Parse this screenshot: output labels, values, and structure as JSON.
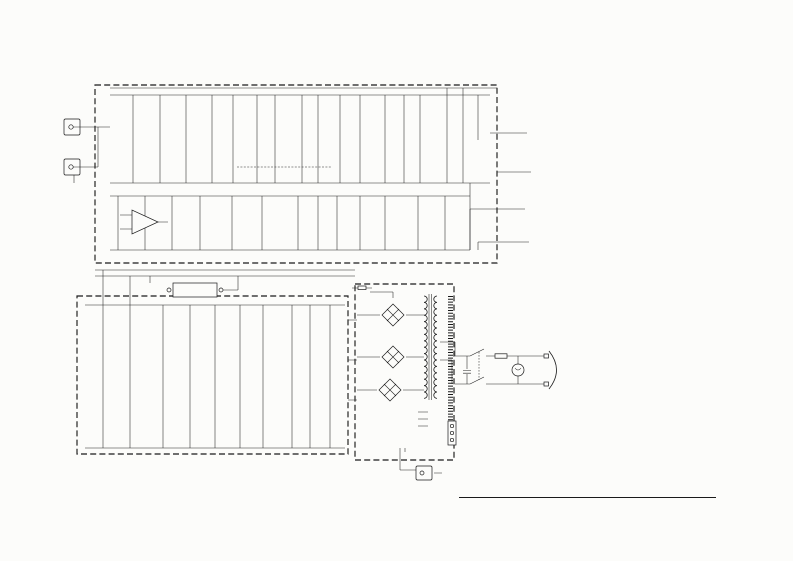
{
  "corner_models": [
    "G100-115 (S/N 1026~)",
    "G100-410 (S/N 1026~)",
    "G100-412 (S/N 1026~)"
  ],
  "sections": {
    "pa": "PA(PAGE 7)",
    "ma": "MA(PAGE 8)",
    "dc": "DC(PAGE 8)"
  },
  "input_label": "INPUT",
  "opamp_label": "AN374",
  "reverb_unit_label": "REVERB UNIT",
  "rec_out_label": "REC OUT",
  "page_number": "4",
  "title": "G100, -115, -410, -412 GUITAR AMPLIFIER SCHEMATIC DIAGRAM",
  "out_jacks": [
    {
      "lines": [
        "PRE-SET",
        "VOLUME"
      ],
      "x": 526,
      "y": 117
    },
    {
      "lines": [
        "DISTORTION"
      ],
      "x": 530,
      "y": 162
    },
    {
      "lines": [
        "TREMOLO"
      ],
      "x": 524,
      "y": 198
    },
    {
      "lines": [
        "REVERB"
      ],
      "x": 528,
      "y": 231
    }
  ],
  "notes": {
    "title": "NOTES:",
    "items": [
      {
        "t": "1. ALL RESISTORS IN OHMS ½ WATT UNLESS OTHERWISE NOTED."
      },
      {
        "t": "2. ALL CAPACITORS IN MFD. UNLESS OTHERWISE NOTED."
      },
      {
        "t": "3. ALL VOLTAGES MEASURED WITH A VTVM, WITH ALL CONTROLS"
      },
      {
        "t": "SET AT MINIMUM.",
        "indent": 1
      },
      {
        "t": "4. WIRE COLOR ABBREVIATIONS"
      },
      {
        "cols": [
          "BL:  BLACK",
          "GR:  GREEN",
          "GG:  LIGHT GREEN"
        ]
      },
      {
        "cols": [
          "BR:  BROWN",
          "BE:  BLUE",
          "SB:  LIGHT BLUE"
        ]
      },
      {
        "cols": [
          "RE:  RED",
          "VI:  VIOLET",
          "PK:  PINK"
        ]
      },
      {
        "cols": [
          "OR:  ORANGE",
          "GY:  GRAY",
          "TR:  TRANSPARENT"
        ]
      },
      {
        "cols": [
          "YE:  YELLOW",
          "WH:  WHITE",
          "TP:  TIN PLATED"
        ]
      },
      {
        "t": "5. TRANSISTORS"
      },
      {
        "t": "TR1, 5, 11, 13-14:  2SK30A (FET)",
        "indent": 1
      },
      {
        "t": "TR2-4, 6-10, 12, 15:  2SC1000",
        "indent": 1
      },
      {
        "t": "TR16:  2SA561",
        "indent": 1
      },
      {
        "t": "TR17-18:  2SA816",
        "indent": 1
      },
      {
        "t": "TR19-20:  2SC793",
        "indent": 1
      },
      {
        "t": "TR21:  2SA482",
        "indent": 1
      },
      {
        "t": "TR22-23:  2SC1985",
        "indent": 1
      },
      {
        "t": "TR24:  2SC684",
        "indent": 1
      },
      {
        "t": "6. DIODES"
      },
      {
        "t": "D1:  STV-3H (VARISTOR)",
        "indent": 1
      },
      {
        "t": "D2-3:  OS151",
        "indent": 1
      },
      {
        "t": "D4-5:  OS151B",
        "indent": 1
      },
      {
        "t": "D6-9/10-13:  RS-1",
        "indent": 1
      }
    ]
  },
  "transistors": [
    {
      "id": "TR1",
      "x": 133,
      "y": 128
    },
    {
      "id": "TR2",
      "x": 212,
      "y": 122
    },
    {
      "id": "TR3",
      "x": 257,
      "y": 131
    },
    {
      "id": "TR4",
      "x": 275,
      "y": 112
    },
    {
      "id": "TR5",
      "x": 318,
      "y": 138
    },
    {
      "id": "TR6",
      "x": 420,
      "y": 125
    },
    {
      "id": "TR7",
      "x": 447,
      "y": 111
    },
    {
      "id": "TR8",
      "x": 464,
      "y": 99
    },
    {
      "id": "TR9",
      "x": 232,
      "y": 217
    },
    {
      "id": "TR10",
      "x": 298,
      "y": 210
    },
    {
      "id": "TR11",
      "x": 337,
      "y": 233
    },
    {
      "id": "TR12",
      "x": 418,
      "y": 217
    },
    {
      "id": "TR13",
      "x": 103,
      "y": 372
    },
    {
      "id": "TR14",
      "x": 130,
      "y": 372
    },
    {
      "id": "TR15",
      "x": 163,
      "y": 331
    },
    {
      "id": "TR16",
      "x": 215,
      "y": 332
    },
    {
      "id": "TR17",
      "x": 207,
      "y": 358
    },
    {
      "id": "TR18",
      "x": 230,
      "y": 358
    },
    {
      "id": "TR19",
      "x": 263,
      "y": 345
    },
    {
      "id": "TR20",
      "x": 292,
      "y": 323
    },
    {
      "id": "TR21",
      "x": 293,
      "y": 385
    },
    {
      "id": "TR22",
      "x": 310,
      "y": 342
    },
    {
      "id": "TR23",
      "x": 308,
      "y": 397
    },
    {
      "id": "TR24",
      "x": 250,
      "y": 315
    }
  ],
  "labels": [
    {
      "x": 103,
      "y": 125,
      "t": "68K",
      "res": 1
    },
    {
      "x": 103,
      "y": 147,
      "t": "68K",
      "res": 1
    },
    {
      "x": 112,
      "y": 104,
      "t": "470/35"
    },
    {
      "x": 117,
      "y": 141,
      "t": "0.047",
      "cap": 1
    },
    {
      "x": 141,
      "y": 107,
      "t": "1/25"
    },
    {
      "x": 158,
      "y": 93,
      "t": "390",
      "res": 1
    },
    {
      "x": 163,
      "y": 112,
      "t": "56K",
      "res": 1
    },
    {
      "x": 168,
      "y": 142,
      "t": "220K",
      "res": 1
    },
    {
      "x": 188,
      "y": 112,
      "t": "8.2K",
      "res": 1
    },
    {
      "x": 201,
      "y": 104,
      "t": "0.0022",
      "cap": 1
    },
    {
      "x": 236,
      "y": 99,
      "t": "270K",
      "res": 1
    },
    {
      "x": 145,
      "y": 118,
      "t": "24.5",
      "box": 1
    },
    {
      "x": 217,
      "y": 136,
      "t": "TREBLE"
    },
    {
      "x": 215,
      "y": 148,
      "t": "BASS"
    },
    {
      "x": 216,
      "y": 160,
      "t": "MIDDLE"
    },
    {
      "x": 198,
      "y": 143,
      "t": "0.047",
      "cap": 1
    },
    {
      "x": 198,
      "y": 156,
      "t": "0.47",
      "cap": 1
    },
    {
      "x": 243,
      "y": 118,
      "t": "150K",
      "res": 1
    },
    {
      "x": 264,
      "y": 104,
      "t": "100K",
      "res": 1
    },
    {
      "x": 287,
      "y": 150,
      "t": "1S1555×2",
      "r": 1
    },
    {
      "x": 305,
      "y": 99,
      "t": "330K",
      "res": 1
    },
    {
      "x": 313,
      "y": 158,
      "t": "10K",
      "res": 1
    },
    {
      "x": 342,
      "y": 103,
      "t": "33K",
      "res": 1
    },
    {
      "x": 353,
      "y": 113,
      "t": "220/25"
    },
    {
      "x": 369,
      "y": 123,
      "t": "0.047",
      "cap": 1
    },
    {
      "x": 391,
      "y": 112,
      "t": "BRIGHT"
    },
    {
      "x": 392,
      "y": 153,
      "t": "VOLUME"
    },
    {
      "x": 384,
      "y": 140,
      "t": "250K",
      "r": 1
    },
    {
      "x": 407,
      "y": 105,
      "t": "22K",
      "res": 1
    },
    {
      "x": 432,
      "y": 105,
      "t": "100K",
      "res": 1
    },
    {
      "x": 472,
      "y": 93,
      "t": "36.8",
      "box": 1
    },
    {
      "x": 452,
      "y": 123,
      "t": "3.3/35"
    },
    {
      "x": 478,
      "y": 143,
      "t": "50K",
      "res": 1
    },
    {
      "x": 489,
      "y": 135,
      "t": "PRE-SET VOLUME",
      "r": 1
    },
    {
      "x": 498,
      "y": 82,
      "t": "+36"
    },
    {
      "x": 266,
      "y": 173,
      "t": "DISTORTION"
    },
    {
      "x": 52,
      "y": 177,
      "t": "+12"
    },
    {
      "x": 112,
      "y": 206,
      "t": "100K",
      "res": 1
    },
    {
      "x": 122,
      "y": 234,
      "t": "4.7K",
      "res": 1
    },
    {
      "x": 143,
      "y": 193,
      "t": "13.8",
      "box": 1
    },
    {
      "x": 160,
      "y": 242,
      "t": "0.0033",
      "cap": 1
    },
    {
      "x": 176,
      "y": 234,
      "t": "22K",
      "res": 1
    },
    {
      "x": 188,
      "y": 214,
      "t": "330/16"
    },
    {
      "x": 218,
      "y": 200,
      "t": "150K",
      "res": 1
    },
    {
      "x": 242,
      "y": 209,
      "t": "1K",
      "res": 1
    },
    {
      "x": 252,
      "y": 232,
      "t": "REVERB",
      "r": 1
    },
    {
      "x": 284,
      "y": 224,
      "t": "3.3/25"
    },
    {
      "x": 291,
      "y": 256,
      "t": "TREMOLO"
    },
    {
      "x": 291,
      "y": 261,
      "t": "INTENSITY"
    },
    {
      "x": 321,
      "y": 198,
      "t": "33/25"
    },
    {
      "x": 350,
      "y": 245,
      "t": "47K",
      "res": 1
    },
    {
      "x": 366,
      "y": 206,
      "t": "1/35",
      "cap": 1
    },
    {
      "x": 391,
      "y": 206,
      "t": "1/35",
      "cap": 1
    },
    {
      "x": 417,
      "y": 197,
      "t": "270K",
      "res": 1
    },
    {
      "x": 433,
      "y": 203,
      "t": "47/25"
    },
    {
      "x": 457,
      "y": 223,
      "t": "8.2K",
      "res": 1
    },
    {
      "x": 90,
      "y": 335,
      "t": "1500/50",
      "r": 1
    },
    {
      "x": 152,
      "y": 309,
      "t": "2.2K",
      "res": 1
    },
    {
      "x": 181,
      "y": 318,
      "t": "180",
      "res": 1
    },
    {
      "x": 198,
      "y": 311,
      "t": "15K",
      "res": 1
    },
    {
      "x": 234,
      "y": 311,
      "t": "5.6K",
      "res": 1
    },
    {
      "x": 243,
      "y": 301,
      "t": "0.1/200",
      "cap": 1
    },
    {
      "x": 102,
      "y": 393,
      "t": "100K",
      "res": 1
    },
    {
      "x": 133,
      "y": 380,
      "t": "10/6"
    },
    {
      "x": 121,
      "y": 399,
      "t": "100K",
      "res": 1
    },
    {
      "x": 137,
      "y": 390,
      "t": "BAL"
    },
    {
      "x": 318,
      "y": 357,
      "t": "0.47 2W",
      "r": 1
    },
    {
      "x": 312,
      "y": 412,
      "t": "0.47 2W",
      "r": 1
    },
    {
      "x": 333,
      "y": 311,
      "t": "560",
      "res": 1
    },
    {
      "x": 265,
      "y": 381,
      "t": "D1"
    },
    {
      "x": 292,
      "y": 303,
      "t": "0.1/200",
      "cap": 1
    },
    {
      "x": 377,
      "y": 306,
      "t": "D2"
    },
    {
      "x": 404,
      "y": 306,
      "t": "D4"
    },
    {
      "x": 377,
      "y": 328,
      "t": "D3"
    },
    {
      "x": 404,
      "y": 328,
      "t": "D5"
    },
    {
      "x": 377,
      "y": 349,
      "t": "D6"
    },
    {
      "x": 404,
      "y": 349,
      "t": "D8"
    },
    {
      "x": 377,
      "y": 370,
      "t": "D7"
    },
    {
      "x": 404,
      "y": 370,
      "t": "D9"
    },
    {
      "x": 373,
      "y": 382,
      "t": "D10"
    },
    {
      "x": 402,
      "y": 382,
      "t": "D12"
    },
    {
      "x": 373,
      "y": 403,
      "t": "D11"
    },
    {
      "x": 402,
      "y": 403,
      "t": "D13"
    },
    {
      "x": 361,
      "y": 284,
      "t": "2A"
    },
    {
      "x": 369,
      "y": 333,
      "t": "0.0047×2"
    },
    {
      "x": 492,
      "y": 345,
      "t": "FOR U.S./CANADIAN MODEL",
      "f": 4
    },
    {
      "x": 498,
      "y": 393,
      "t": "LEAD TYPE 4A"
    },
    {
      "x": 467,
      "y": 409,
      "t": "C 0.0047MF AC 250V"
    },
    {
      "x": 539,
      "y": 352,
      "t": "WH"
    },
    {
      "x": 539,
      "y": 394,
      "t": "BL"
    },
    {
      "x": 431,
      "y": 413,
      "t": "PA(+36)"
    },
    {
      "x": 431,
      "y": 420,
      "t": "PA(+12)"
    },
    {
      "x": 431,
      "y": 427,
      "t": "E"
    },
    {
      "x": 404,
      "y": 457,
      "t": "1000/100",
      "cap": 1
    },
    {
      "x": 437,
      "y": 461,
      "t": "WH"
    },
    {
      "x": 409,
      "y": 299,
      "t": "AC1 RE"
    },
    {
      "x": 409,
      "y": 336,
      "t": "AC2 OR"
    },
    {
      "x": 409,
      "y": 364,
      "t": "AC3 GR"
    }
  ],
  "taps": {
    "x": 441,
    "list": [
      {
        "y": 298,
        "t": "50V RE"
      },
      {
        "y": 323,
        "t": "0V BE"
      },
      {
        "y": 333,
        "t": "30V GR"
      },
      {
        "y": 342,
        "t": "117V OR"
      },
      {
        "y": 352,
        "t": "100V OR"
      },
      {
        "y": 360,
        "t": "100V YE"
      }
    ]
  },
  "grounds": [
    [
      74,
      186
    ],
    [
      425,
      488
    ]
  ],
  "speakers": [
    {
      "model": "G100-115",
      "desc": "SINGLE 15\"(38cm)",
      "part": "JA-3802",
      "x": 468,
      "y": 412,
      "w": 84,
      "h": 45,
      "count": 1
    },
    {
      "model": "G100-410",
      "desc": "FOUR 10\"(25cm)",
      "part": "JA-2556",
      "x": 557,
      "y": 412,
      "w": 78,
      "h": 56,
      "count": 4
    },
    {
      "model": "G100-412",
      "desc": "FOUR 12\"(30cm)",
      "part": "JA-3059",
      "x": 645,
      "y": 412,
      "w": 78,
      "h": 56,
      "count": 4
    }
  ]
}
